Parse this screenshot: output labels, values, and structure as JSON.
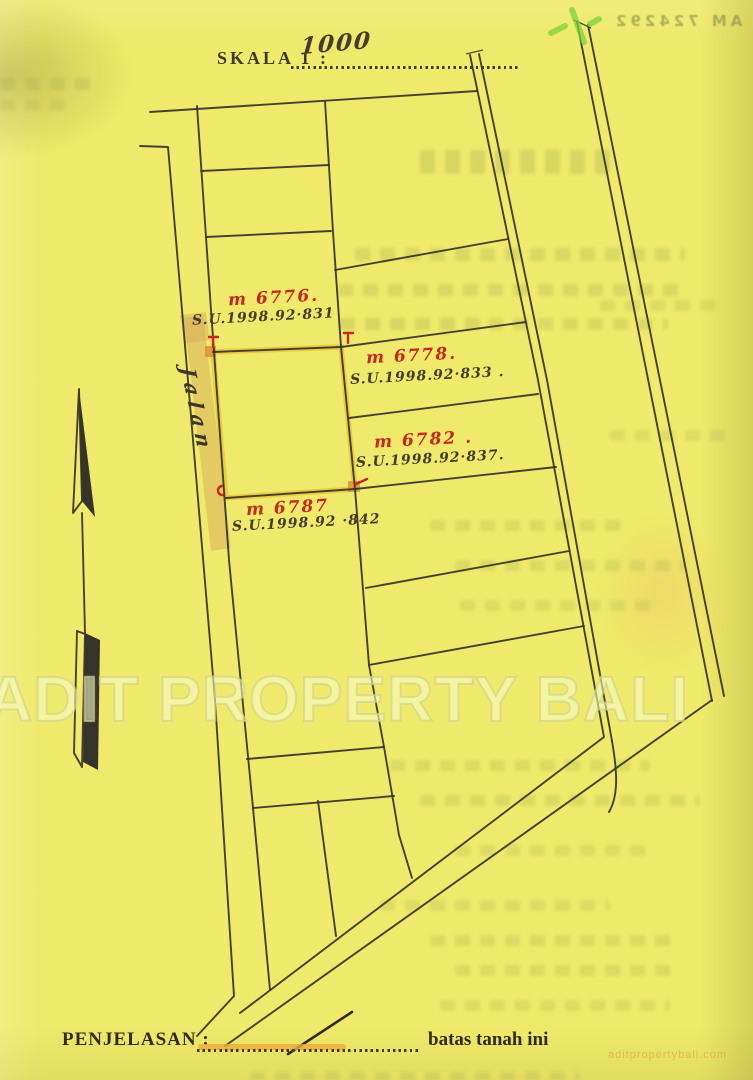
{
  "document": {
    "scale_label": "SKALA 1 :",
    "scale_value": "1000",
    "legend_label": "PENJELASAN :",
    "legend_caption": "batas tanah ini",
    "road_label": "Jalan",
    "bleedthrough_serial": "AM 724292"
  },
  "watermark": {
    "main": "ADIT PROPERTY BALI",
    "corner": "aditpropertybali.com"
  },
  "plots": [
    {
      "id": "plot-6776",
      "no": "m 6776.",
      "su": "S.U.1998.92·831"
    },
    {
      "id": "plot-6778",
      "no": "m 6778.",
      "su": "S.U.1998.92·833 ."
    },
    {
      "id": "plot-6782",
      "no": "m 6782 .",
      "su": "S.U.1998.92·837."
    },
    {
      "id": "plot-6787",
      "no": "m 6787",
      "su": "S.U.1998.92 ·842"
    }
  ],
  "colors": {
    "paper": "#EFEA6B",
    "ink": "#35332A",
    "red_ink": "#C8271C",
    "plot_highlight": "#E8C637",
    "corner_highlight": "#DD8F2E",
    "road_highlight": "#D9A95C",
    "green_mark": "#7FD23C"
  }
}
